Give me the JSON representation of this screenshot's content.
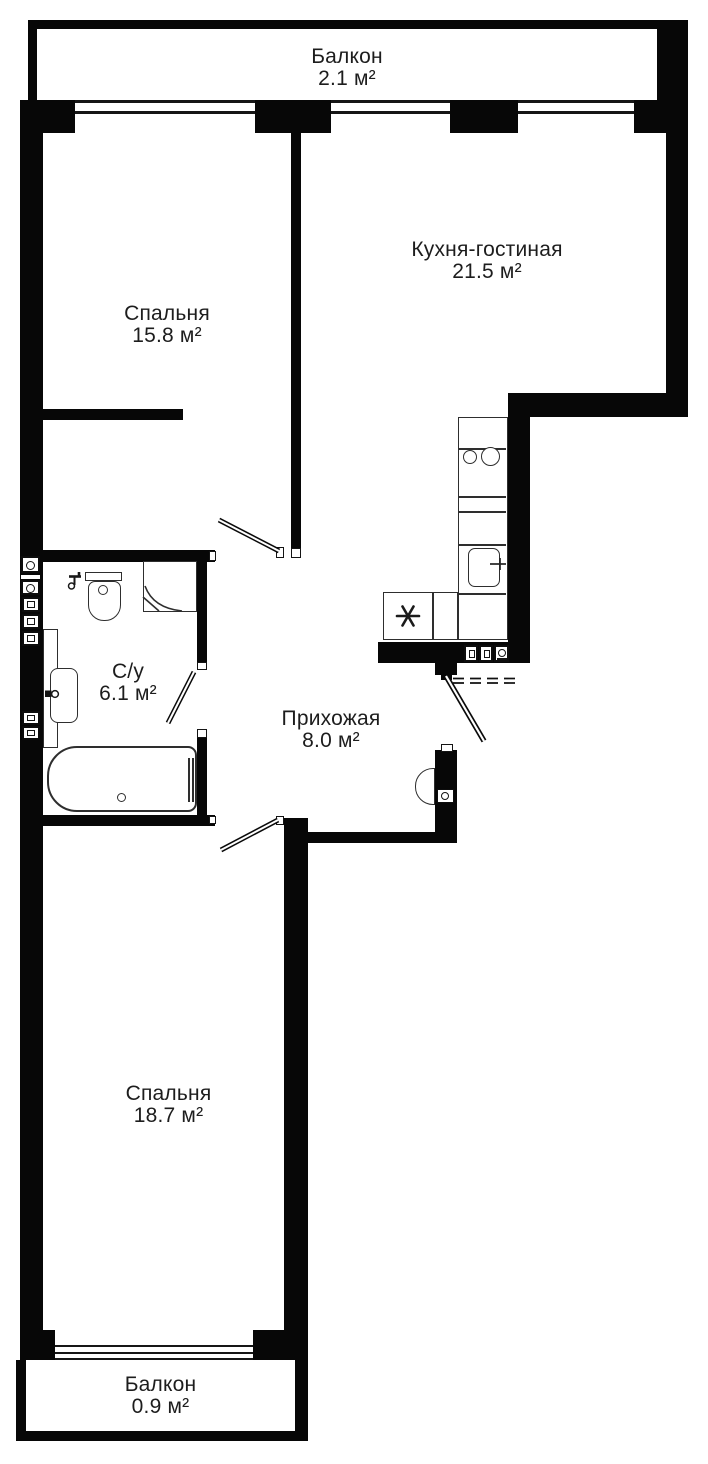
{
  "colors": {
    "wall": "#070707",
    "line": "#2e2e2e",
    "text": "#1d1d1d",
    "bg": "#ffffff"
  },
  "rooms": {
    "balcony_top": {
      "name": "Балкон",
      "area": "2.1 м²"
    },
    "bedroom_1": {
      "name": "Спальня",
      "area": "15.8 м²"
    },
    "kitchen_living": {
      "name": "Кухня-гостиная",
      "area": "21.5 м²"
    },
    "bathroom": {
      "name": "С/у",
      "area": "6.1 м²"
    },
    "hallway": {
      "name": "Прихожая",
      "area": "8.0 м²"
    },
    "bedroom_2": {
      "name": "Спальня",
      "area": "18.7 м²"
    },
    "balcony_bottom": {
      "name": "Балкон",
      "area": "0.9 м²"
    }
  },
  "icons": {
    "fridge": "fridge-icon",
    "hob": "hob-icon",
    "kitchen_sink": "kitchen-sink-icon",
    "toilet": "toilet-icon",
    "shower": "shower-icon",
    "washbasin": "washbasin-icon",
    "bathtub": "bathtub-icon",
    "intercom": "intercom-icon",
    "door": "door-leaf-icon",
    "window": "window-glazing",
    "vent": "vent-shaft-icon"
  }
}
